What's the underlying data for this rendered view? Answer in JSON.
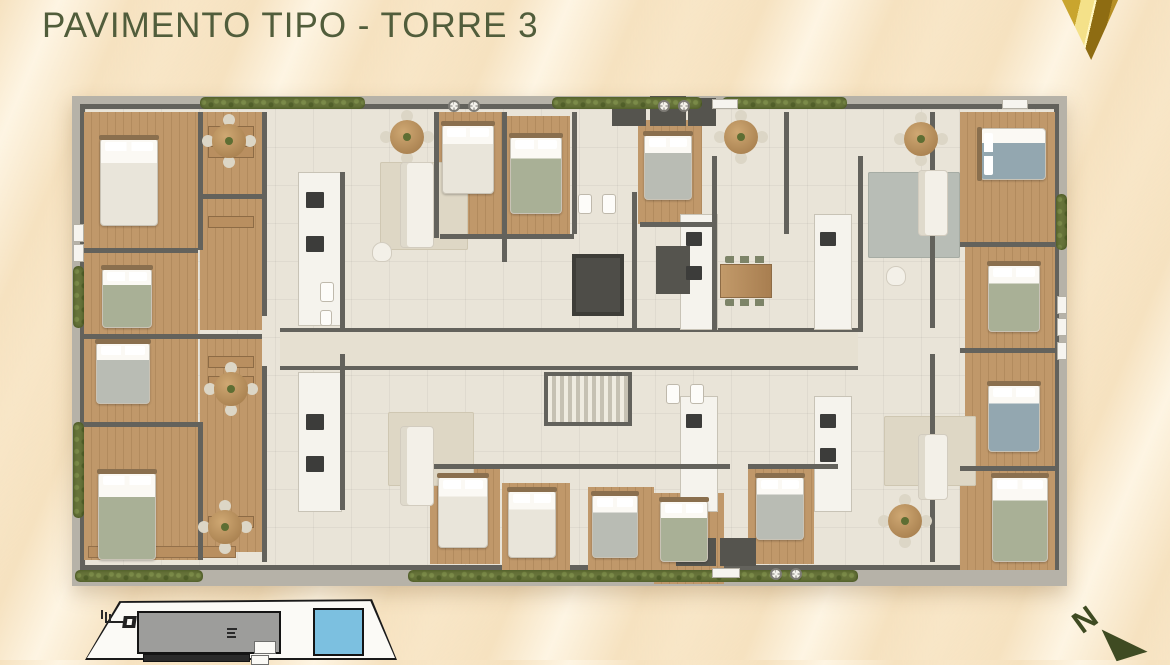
{
  "title": "PAVIMENTO TIPO - TORRE 3",
  "compass": {
    "label": "N"
  },
  "colors": {
    "title": "#515d3b",
    "background": "#f6e2c0",
    "background_streak": "#fdf3e1",
    "wall": "#63625c",
    "floor": "#e9e4d8",
    "wood": "#c0986a",
    "hedge": "#67743a",
    "concrete": "#b6b2a8",
    "gold": "#d3a938",
    "pool": "#7cc0e0",
    "compass": "#3f4b22"
  },
  "floorplan": {
    "items": [
      [
        "corr",
        208,
        232,
        578,
        42
      ],
      [
        "wood",
        12,
        16,
        114,
        136
      ],
      [
        "wood",
        12,
        157,
        114,
        81
      ],
      [
        "wood",
        12,
        243,
        114,
        83
      ],
      [
        "wood",
        12,
        331,
        114,
        133
      ],
      [
        "wood",
        128,
        16,
        62,
        218
      ],
      [
        "wood",
        128,
        238,
        62,
        218
      ],
      [
        "wood",
        366,
        16,
        64,
        124
      ],
      [
        "wood",
        432,
        20,
        66,
        120
      ],
      [
        "wood",
        566,
        24,
        64,
        104
      ],
      [
        "wood",
        888,
        16,
        95,
        130
      ],
      [
        "wood",
        893,
        151,
        90,
        101
      ],
      [
        "wood",
        893,
        257,
        90,
        113
      ],
      [
        "wood",
        888,
        375,
        95,
        99
      ],
      [
        "wood",
        358,
        373,
        70,
        95
      ],
      [
        "wood",
        430,
        387,
        68,
        93
      ],
      [
        "wood",
        516,
        391,
        66,
        93
      ],
      [
        "wood",
        582,
        397,
        70,
        91
      ],
      [
        "wood",
        676,
        373,
        66,
        95
      ],
      [
        "rug",
        308,
        66,
        88,
        88
      ],
      [
        "rugg",
        796,
        76,
        92,
        86
      ],
      [
        "rug",
        316,
        316,
        86,
        74
      ],
      [
        "rug",
        812,
        320,
        92,
        70
      ],
      [
        "gal",
        226,
        76,
        44,
        154
      ],
      [
        "gal",
        226,
        276,
        44,
        140
      ],
      [
        "gal",
        608,
        118,
        38,
        116
      ],
      [
        "gal",
        742,
        118,
        38,
        116
      ],
      [
        "gal",
        608,
        300,
        38,
        116
      ],
      [
        "gal",
        742,
        300,
        38,
        116
      ],
      [
        "desk",
        16,
        450,
        148,
        12
      ],
      [
        "wall",
        126,
        16,
        5,
        138
      ],
      [
        "wall",
        126,
        326,
        5,
        138
      ],
      [
        "wall",
        190,
        16,
        5,
        204
      ],
      [
        "wall",
        190,
        270,
        5,
        196
      ],
      [
        "wall",
        268,
        76,
        5,
        156
      ],
      [
        "wall",
        268,
        258,
        5,
        156
      ],
      [
        "wall",
        362,
        16,
        5,
        126
      ],
      [
        "wall",
        430,
        16,
        5,
        150
      ],
      [
        "wall",
        500,
        16,
        5,
        122
      ],
      [
        "wall",
        560,
        96,
        5,
        140
      ],
      [
        "wall",
        640,
        60,
        5,
        176
      ],
      [
        "wall",
        712,
        16,
        5,
        122
      ],
      [
        "wall",
        786,
        60,
        5,
        176
      ],
      [
        "wall",
        858,
        16,
        5,
        216
      ],
      [
        "wall",
        858,
        258,
        5,
        208
      ],
      [
        "wall",
        12,
        152,
        114,
        5
      ],
      [
        "wall",
        12,
        238,
        178,
        5
      ],
      [
        "wall",
        12,
        326,
        114,
        5
      ],
      [
        "wall",
        128,
        98,
        62,
        5
      ],
      [
        "wall",
        368,
        138,
        134,
        5
      ],
      [
        "wall",
        568,
        126,
        77,
        5
      ],
      [
        "wall",
        888,
        146,
        95,
        5
      ],
      [
        "wall",
        888,
        252,
        95,
        5
      ],
      [
        "wall",
        888,
        370,
        95,
        5
      ],
      [
        "wall",
        358,
        368,
        300,
        5
      ],
      [
        "wall",
        676,
        368,
        90,
        5
      ],
      [
        "dark",
        540,
        2,
        34,
        28
      ],
      [
        "dark",
        578,
        0,
        36,
        30
      ],
      [
        "dark",
        616,
        2,
        28,
        28
      ],
      [
        "dark",
        604,
        442,
        40,
        28
      ],
      [
        "dark",
        648,
        442,
        36,
        28
      ],
      [
        "dark",
        584,
        150,
        34,
        48
      ],
      [
        "elev",
        500,
        158,
        52,
        62
      ],
      [
        "stairs",
        472,
        276,
        88,
        54
      ],
      [
        "hedge",
        128,
        1,
        165,
        12
      ],
      [
        "hedge",
        480,
        1,
        150,
        12
      ],
      [
        "hedge",
        650,
        1,
        125,
        12
      ],
      [
        "hedge",
        3,
        474,
        128,
        12
      ],
      [
        "hedge",
        336,
        474,
        450,
        12
      ],
      [
        "hedge",
        1,
        170,
        11,
        62
      ],
      [
        "hedge",
        1,
        326,
        11,
        96
      ],
      [
        "hedge",
        984,
        98,
        11,
        56
      ],
      [
        "ac",
        1,
        128,
        11,
        18
      ],
      [
        "ac",
        1,
        148,
        11,
        18
      ],
      [
        "ac",
        985,
        200,
        10,
        18
      ],
      [
        "ac",
        985,
        222,
        10,
        18
      ],
      [
        "ac",
        985,
        246,
        10,
        18
      ],
      [
        "ac",
        640,
        3,
        26,
        10
      ],
      [
        "ac",
        930,
        3,
        26,
        10
      ],
      [
        "ac",
        640,
        472,
        28,
        10
      ],
      [
        "fan",
        376,
        4,
        12,
        12
      ],
      [
        "fan",
        396,
        4,
        12,
        12
      ],
      [
        "fan",
        586,
        4,
        12,
        12
      ],
      [
        "fan",
        606,
        4,
        12,
        12
      ],
      [
        "fan",
        698,
        472,
        12,
        12
      ],
      [
        "fan",
        718,
        472,
        12,
        12
      ],
      [
        "ward",
        136,
        30,
        46,
        12
      ],
      [
        "ward",
        136,
        50,
        46,
        12
      ],
      [
        "ward",
        136,
        120,
        46,
        12
      ],
      [
        "ward",
        136,
        260,
        46,
        12
      ],
      [
        "ward",
        136,
        280,
        46,
        12
      ],
      [
        "ward",
        136,
        420,
        46,
        12
      ],
      [
        "app",
        234,
        96,
        18,
        16
      ],
      [
        "app",
        234,
        140,
        18,
        16
      ],
      [
        "app",
        234,
        318,
        18,
        16
      ],
      [
        "app",
        234,
        360,
        18,
        16
      ],
      [
        "app",
        614,
        136,
        16,
        14
      ],
      [
        "app",
        614,
        170,
        16,
        14
      ],
      [
        "app",
        748,
        136,
        16,
        14
      ],
      [
        "app",
        614,
        318,
        16,
        14
      ],
      [
        "app",
        748,
        318,
        16,
        14
      ],
      [
        "app",
        748,
        352,
        16,
        14
      ],
      [
        "bed",
        28,
        42,
        58,
        88,
        ""
      ],
      [
        "bed",
        30,
        172,
        50,
        60,
        "green"
      ],
      [
        "bed",
        24,
        246,
        54,
        62,
        "gray"
      ],
      [
        "bed",
        26,
        376,
        58,
        88,
        "green"
      ],
      [
        "bed",
        370,
        28,
        52,
        70,
        ""
      ],
      [
        "bed",
        438,
        40,
        52,
        78,
        "green"
      ],
      [
        "bed",
        572,
        38,
        48,
        66,
        "gray"
      ],
      [
        "bed",
        908,
        32,
        66,
        52,
        "h blue"
      ],
      [
        "bed",
        916,
        168,
        52,
        68,
        "green"
      ],
      [
        "bed",
        916,
        288,
        52,
        68,
        "blue"
      ],
      [
        "bed",
        920,
        380,
        56,
        86,
        "green"
      ],
      [
        "bed",
        366,
        380,
        50,
        72,
        ""
      ],
      [
        "bed",
        436,
        394,
        48,
        68,
        ""
      ],
      [
        "bed",
        520,
        398,
        46,
        64,
        "gray"
      ],
      [
        "bed",
        588,
        404,
        48,
        62,
        "green"
      ],
      [
        "bed",
        684,
        380,
        48,
        64,
        "gray"
      ],
      [
        "rtab",
        140,
        28,
        34,
        34
      ],
      [
        "rtab",
        318,
        24,
        34,
        34
      ],
      [
        "rtab",
        652,
        24,
        34,
        34
      ],
      [
        "rtab",
        832,
        26,
        34,
        34
      ],
      [
        "rtab",
        142,
        276,
        34,
        34
      ],
      [
        "rtab",
        136,
        414,
        34,
        34
      ],
      [
        "rtab",
        816,
        408,
        34,
        34
      ],
      [
        "rectt",
        648,
        168,
        52,
        34
      ],
      [
        "sofa",
        328,
        66,
        34,
        86
      ],
      [
        "sofa",
        846,
        74,
        30,
        66
      ],
      [
        "sofa",
        328,
        330,
        34,
        80
      ],
      [
        "sofa",
        846,
        338,
        30,
        66
      ],
      [
        "chair",
        300,
        146,
        20,
        20
      ],
      [
        "chair",
        814,
        170,
        20,
        20
      ],
      [
        "fix",
        506,
        98,
        14,
        20
      ],
      [
        "fix",
        530,
        98,
        14,
        20
      ],
      [
        "fix",
        594,
        288,
        14,
        20
      ],
      [
        "fix",
        618,
        288,
        14,
        20
      ],
      [
        "fix",
        248,
        186,
        14,
        20
      ],
      [
        "fix",
        248,
        214,
        12,
        16
      ]
    ]
  }
}
